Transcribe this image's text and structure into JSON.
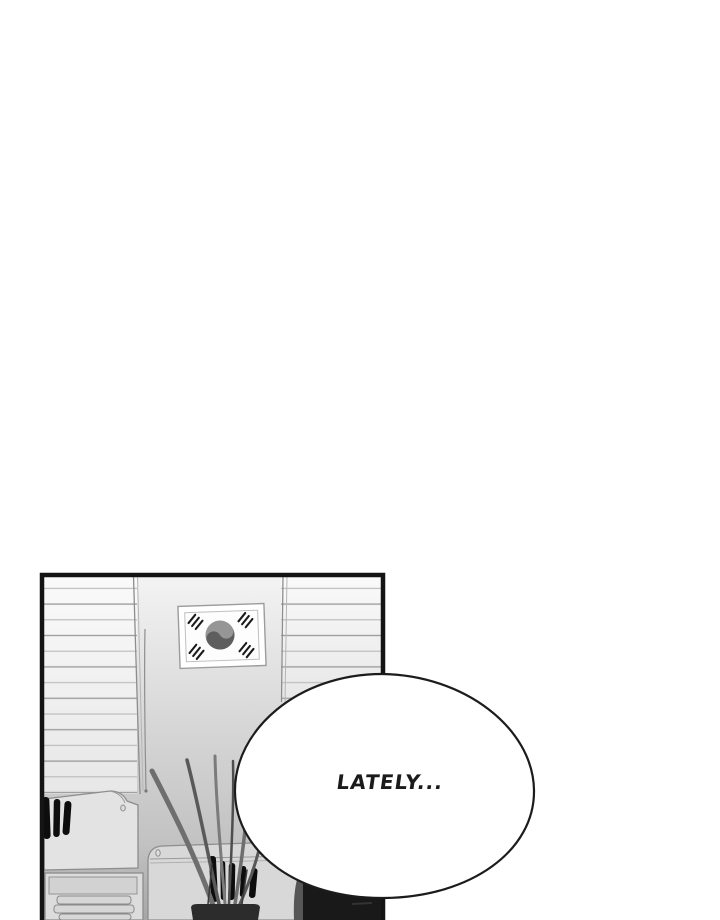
{
  "page": {
    "width": 720,
    "height": 920
  },
  "speech_bubble": {
    "text": "LATELY...",
    "fill": "#ffffff",
    "stroke": "#1c1c1c"
  },
  "scene": {
    "panel": "manhwa-panel",
    "flag": "korean-flag",
    "flag_symbol": "taegeuk",
    "window_left": "louvered-blinds",
    "window_right": "louvered-blinds",
    "plant": "potted-snake-plant"
  },
  "colors": {
    "page_bg": "#ffffff",
    "panel_border": "#141414",
    "wall_top": "#f4f4f4",
    "wall_mid": "#d6d6d6",
    "wall_bottom": "#a6a6a6",
    "blind_top": "#fafafa",
    "blind_bottom": "#e7e7e7",
    "slat_dark": "#9f9f9f",
    "slat_light": "#b9b9b9",
    "outline": "#8d8d8d",
    "machine_left": "#e3e3e3",
    "machine_mid": "#d8d8d8",
    "furniture": "#dcdcdc",
    "ink_black": "#0d0d0d",
    "leaf_dark": "#4e4e4e",
    "leaf_mid": "#6e6e6e",
    "leaf_light": "#7b7b7b",
    "pot": "#2c2c2c",
    "chair": "#565656",
    "cabinet_dark": "#191919",
    "flag_frame": "#9c9c9c",
    "taegeuk_light": "#969696",
    "taegeuk_dark": "#5e5e5e",
    "bubble_fill": "#ffffff",
    "bubble_stroke": "#1c1c1c",
    "text_ink": "#1b1b1b"
  }
}
